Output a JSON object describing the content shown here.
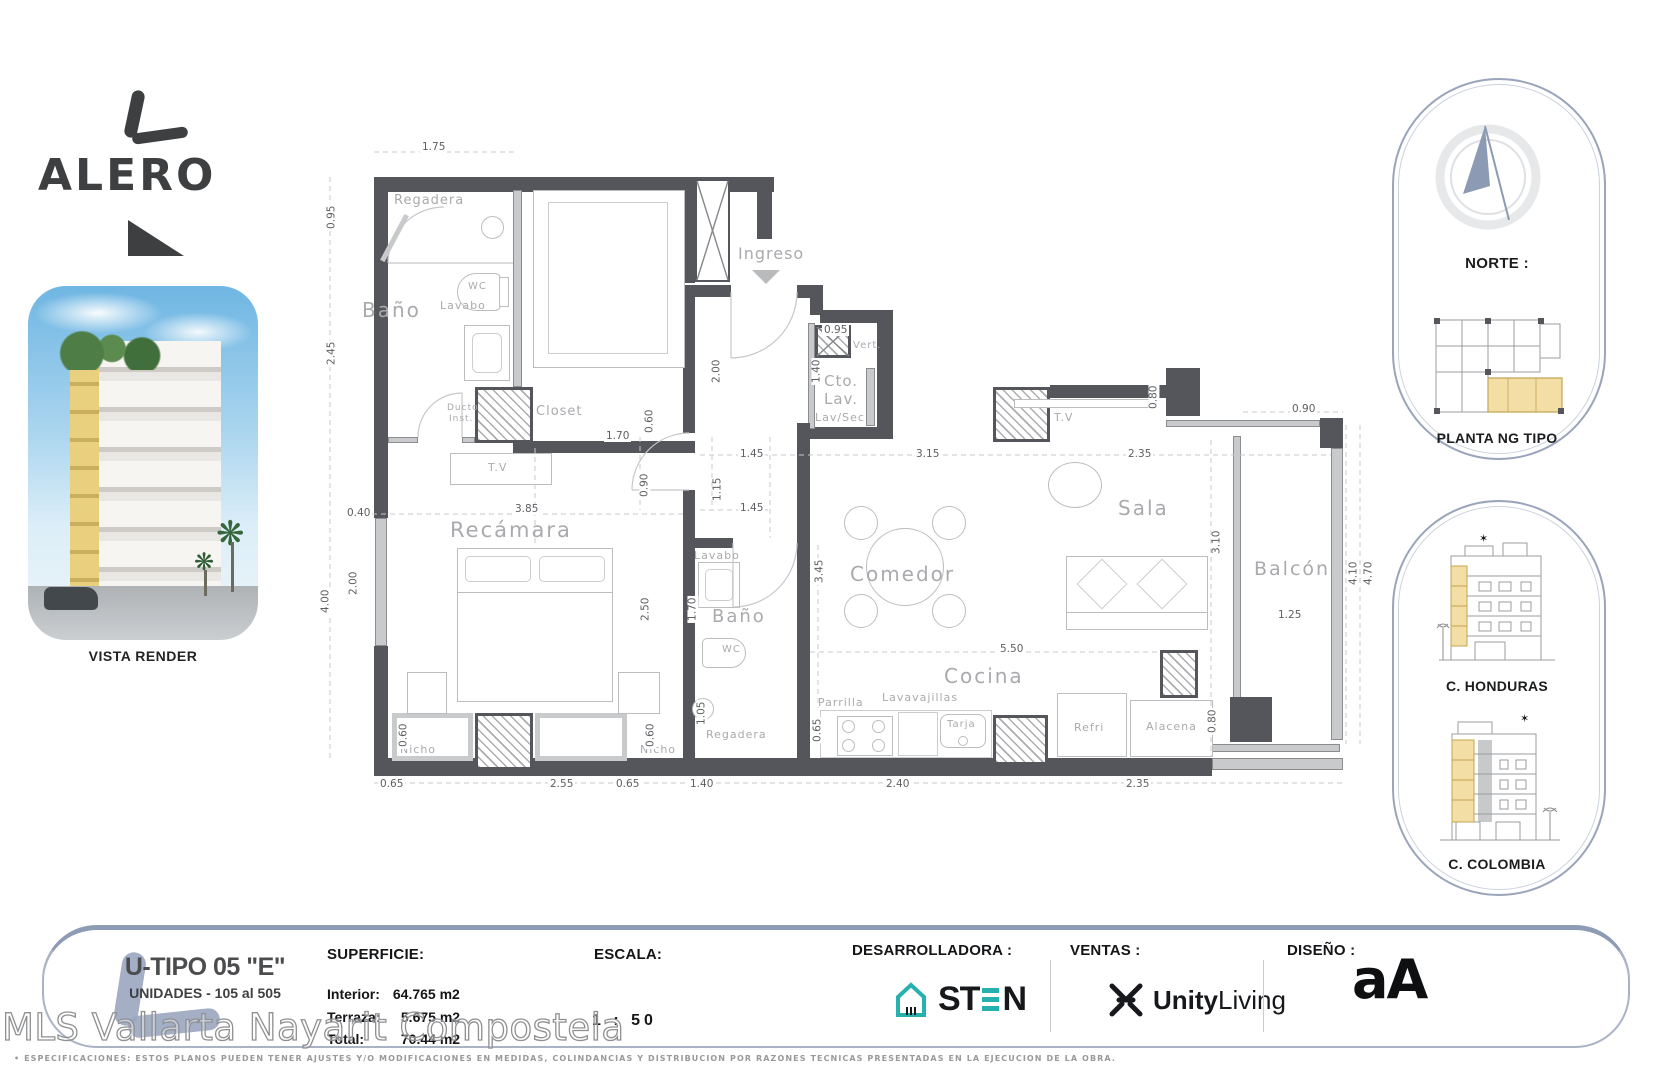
{
  "colors": {
    "wall_dark": "#54565B",
    "accent_blue": "#8D9BB4",
    "highlight_yellow": "#F3DFA5",
    "brand_teal": "#27B1AE",
    "label_gray": "#A9AAAD"
  },
  "logo": {
    "name": "ALERO"
  },
  "vista": {
    "caption": "VISTA RENDER"
  },
  "north": {
    "label": "NORTE :",
    "caption": "PLANTA NG TIPO"
  },
  "elevations": {
    "honduras": "C. HONDURAS",
    "colombia": "C. COLOMBIA"
  },
  "plan": {
    "rooms": {
      "bano1": "Baño",
      "regadera1": "Regadera",
      "wc1": "WC",
      "lavabo1": "Lavabo",
      "ducto_a": "Ducto",
      "ducto_b": "Inst.",
      "closet": "Closet",
      "tv1": "T.V",
      "recamara": "Recámara",
      "nicho1": "Nicho",
      "nicho2": "Nicho",
      "ingreso": "Ingreso",
      "vert": "Vert.",
      "cto1": "Cto.",
      "cto2": "Lav.",
      "lavsec": "Lav/Sec",
      "lavabo2": "Lavabo",
      "bano2": "Baño",
      "wc2": "WC",
      "regadera2": "Regadera",
      "tv2": "T.V",
      "sala": "Sala",
      "comedor": "Comedor",
      "cocina": "Cocina",
      "parrilla": "Parrilla",
      "lavavajillas": "Lavavajillas",
      "tarja": "Tarja",
      "refri": "Refri",
      "alacena": "Alacena",
      "balcon": "Balcón"
    },
    "dims": [
      "1.75",
      "0.95",
      "2.45",
      "0.40",
      "2.00",
      "4.00",
      "0.60",
      "0.60",
      "0.65",
      "2.55",
      "0.65",
      "1.40",
      "2.40",
      "2.35",
      "1.70",
      "0.60",
      "0.90",
      "1.15",
      "1.45",
      "1.45",
      "3.15",
      "2.35",
      "3.85",
      "2.50",
      "1.70",
      "3.45",
      "1.05",
      "0.65",
      "5.50",
      "3.10",
      "0.80",
      "0.80",
      "0.90",
      "4.10",
      "4.70",
      "1.25",
      "2.00",
      "1.40",
      "0.95"
    ]
  },
  "titleblock": {
    "unit_type": "U-TIPO 05 \"E\"",
    "units": "UNIDADES - 105 al 505",
    "superficie_label": "SUPERFICIE:",
    "rows": [
      {
        "label": "Interior:",
        "value": "64.765 m2"
      },
      {
        "label": "Terraza:",
        "value": "5.675 m2"
      },
      {
        "label": "Total:",
        "value": "70.44  m2"
      }
    ],
    "escala_label": "ESCALA:",
    "escala_value": "1 : 50",
    "desarrolladora_label": "DESARROLLADORA :",
    "sten_st": "ST",
    "sten_n": "N",
    "ventas_label": "VENTAS :",
    "ventas_bold": "Unity",
    "ventas_light": "Living",
    "diseno_label": "DISEÑO :",
    "diseno_logo": "aA"
  },
  "watermark": "MLS Vallarta Nayarit Compostela",
  "fineprint": "• ESPECIFICACIONES:  ESTOS  PLANOS  PUEDEN  TENER  AJUSTES  Y/O  MODIFICACIONES  EN  MEDIDAS, COLINDANCIAS Y DISTRIBUCION POR  RAZONES  TECNICAS  PRESENTADAS  EN LA EJECUCION DE LA OBRA."
}
